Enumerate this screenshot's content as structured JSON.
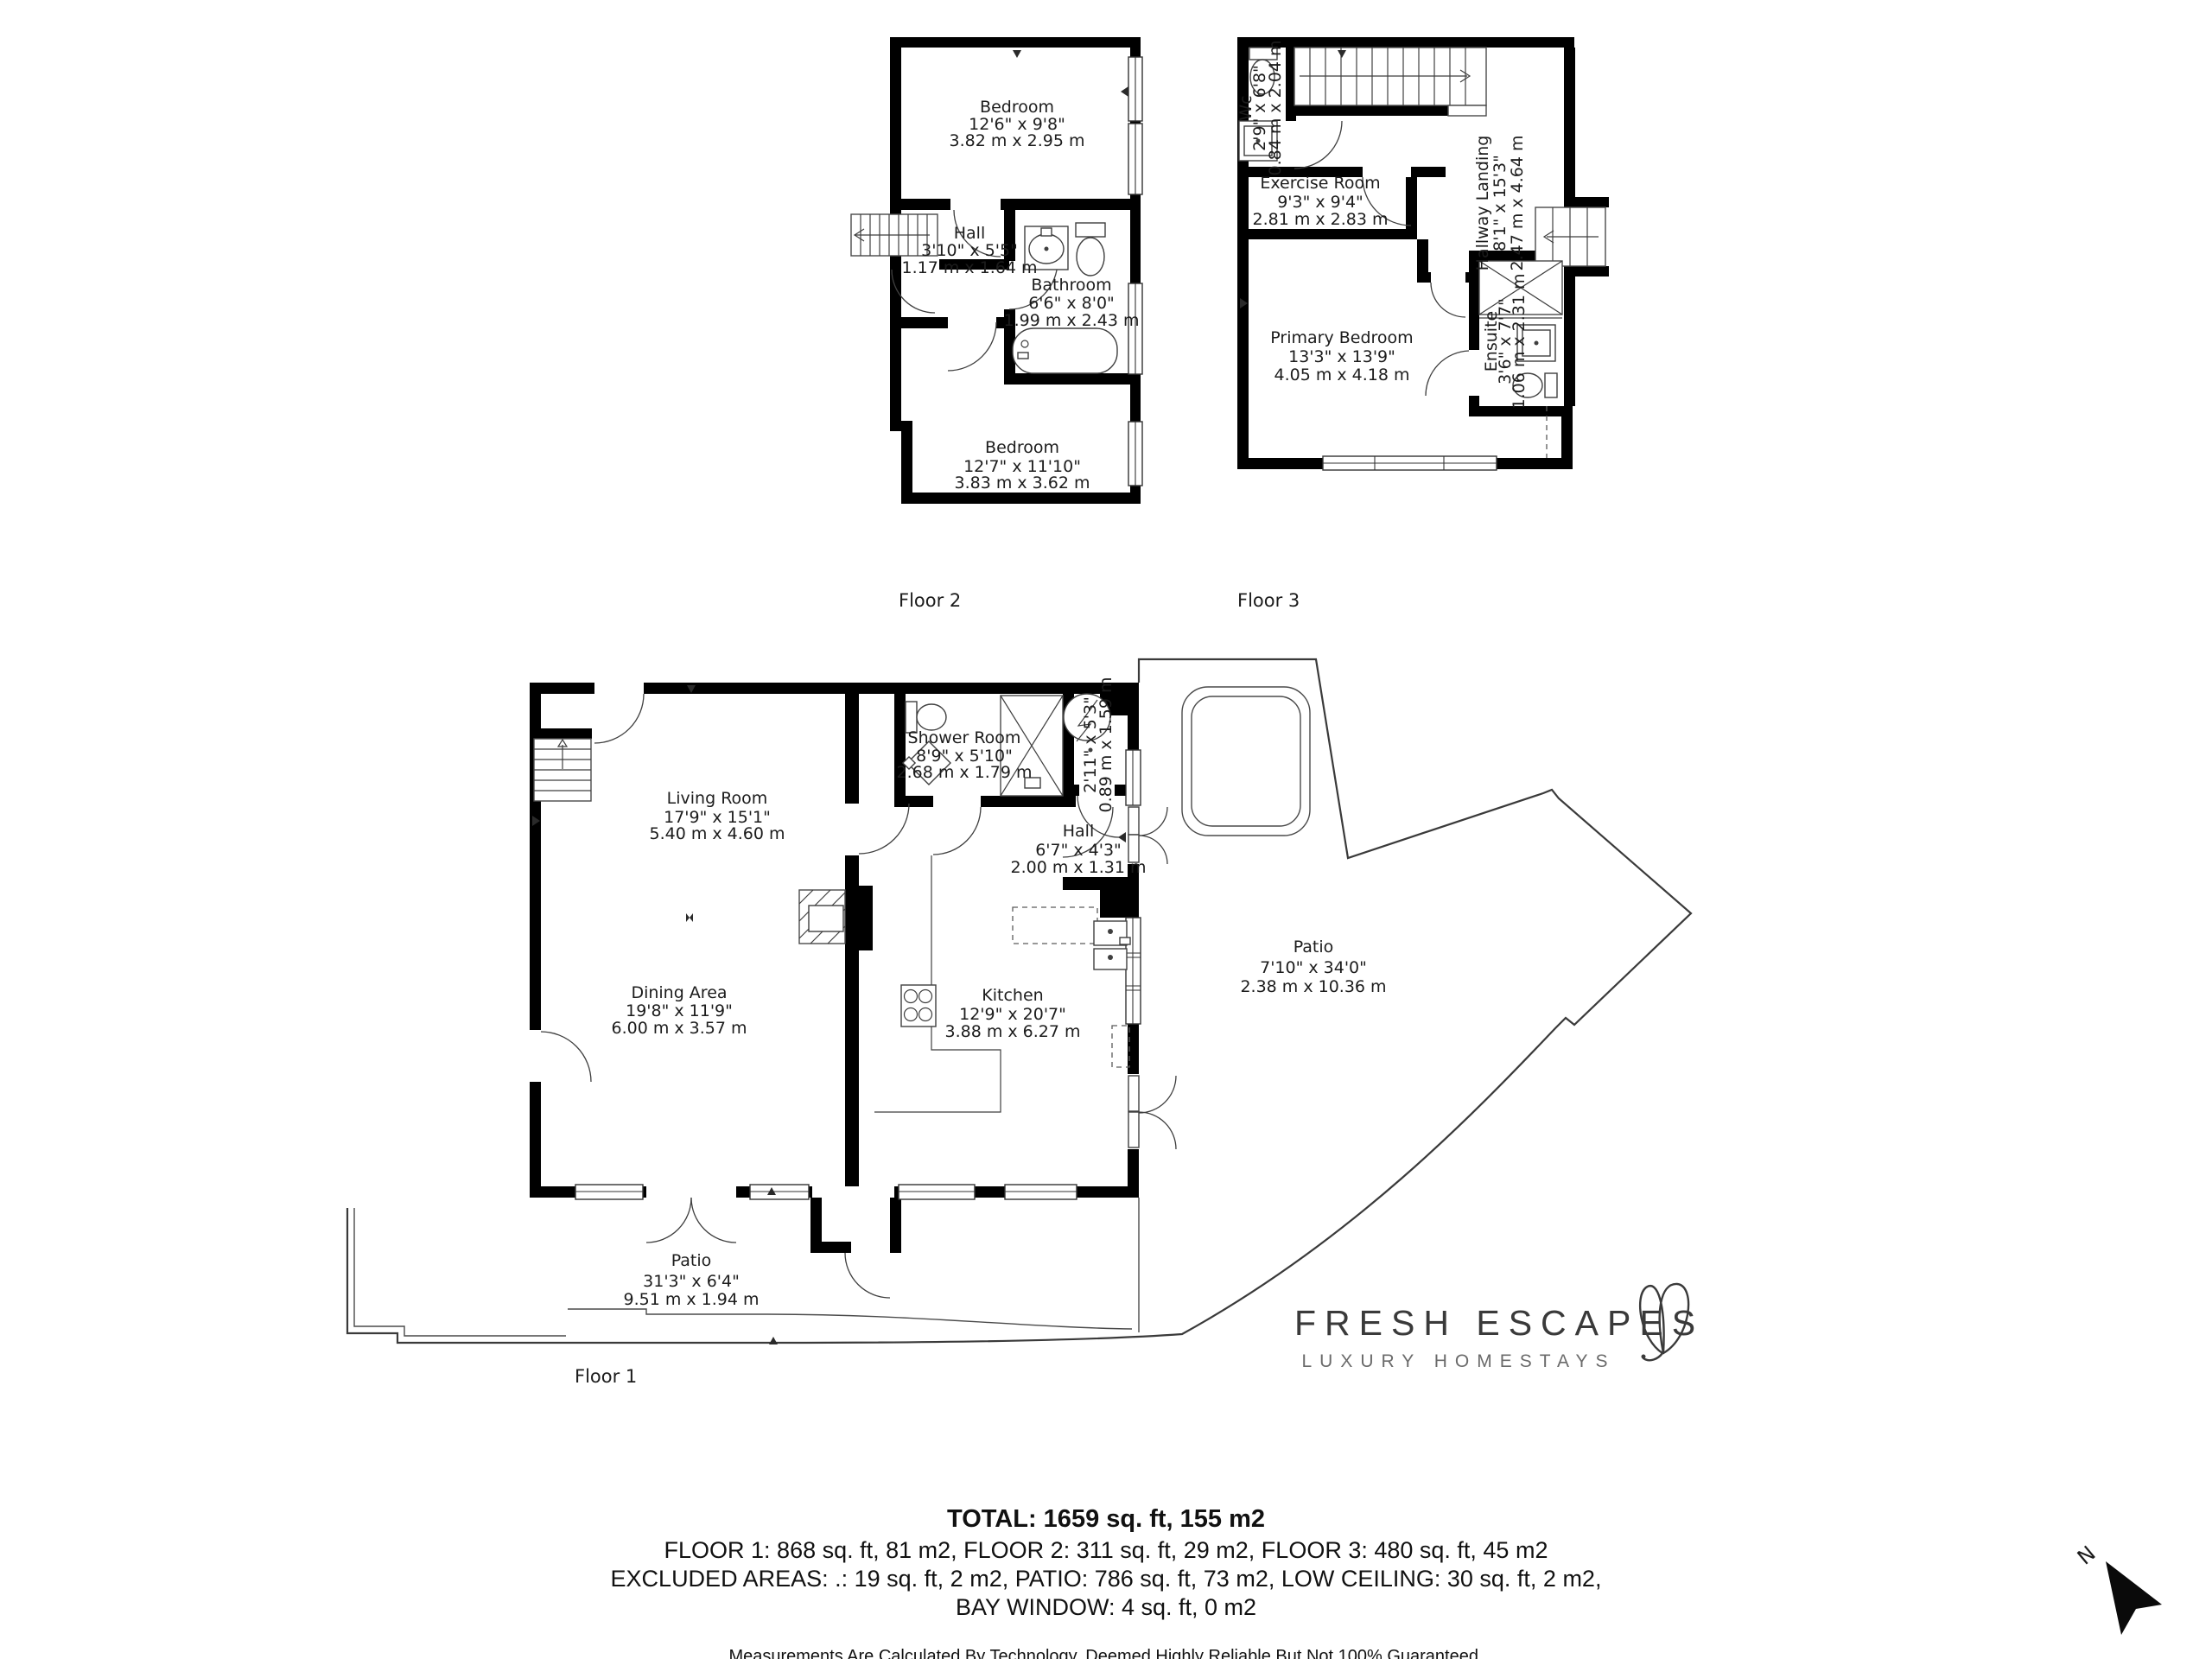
{
  "colors": {
    "wall": "#000000",
    "fixture_line": "#3f3f3f",
    "label_text": "#1c1c1c",
    "brand_text": "#3a3a3a",
    "tagline_text": "#6b6b6b"
  },
  "floor1": {
    "label": "Floor 1",
    "living_room": {
      "name": "Living Room",
      "imperial": "17'9\" x 15'1\"",
      "metric": "5.40 m x 4.60 m"
    },
    "dining_area": {
      "name": "Dining Area",
      "imperial": "19'8\" x 11'9\"",
      "metric": "6.00 m x 3.57 m"
    },
    "shower_room": {
      "name": "Shower Room",
      "imperial": "8'9\" x 5'10\"",
      "metric": "2.68 m x 1.79 m"
    },
    "closet": {
      "imperial": "2'11\" x 5'3\"",
      "metric": "0.89 m x 1.59 m"
    },
    "hall": {
      "name": "Hall",
      "imperial": "6'7\" x 4'3\"",
      "metric": "2.00 m x 1.31 m"
    },
    "kitchen": {
      "name": "Kitchen",
      "imperial": "12'9\" x 20'7\"",
      "metric": "3.88 m x 6.27 m"
    },
    "patio_side": {
      "name": "Patio",
      "imperial": "7'10\" x 34'0\"",
      "metric": "2.38 m x 10.36 m"
    },
    "patio_front": {
      "name": "Patio",
      "imperial": "31'3\" x 6'4\"",
      "metric": "9.51 m x 1.94 m"
    }
  },
  "floor2": {
    "label": "Floor 2",
    "bedroom_top": {
      "name": "Bedroom",
      "imperial": "12'6\" x 9'8\"",
      "metric": "3.82 m x 2.95 m"
    },
    "hall": {
      "name": "Hall",
      "imperial": "3'10\" x 5'5\"",
      "metric": "1.17 m x 1.64 m"
    },
    "bathroom": {
      "name": "Bathroom",
      "imperial": "6'6\" x 8'0\"",
      "metric": "1.99 m x 2.43 m"
    },
    "bedroom_bottom": {
      "name": "Bedroom",
      "imperial": "12'7\" x 11'10\"",
      "metric": "3.83 m x 3.62 m"
    }
  },
  "floor3": {
    "label": "Floor 3",
    "wc": {
      "name": "Wc",
      "imperial": "2'9\" x 6'8\"",
      "metric": "0.84 m x 2.04 m"
    },
    "exercise_room": {
      "name": "Exercise Room",
      "imperial": "9'3\" x 9'4\"",
      "metric": "2.81 m x 2.83 m"
    },
    "hallway_landing": {
      "name": "Hallway Landing",
      "imperial": "8'1\" x 15'3\"",
      "metric": "2.47 m x 4.64 m"
    },
    "primary_bedroom": {
      "name": "Primary Bedroom",
      "imperial": "13'3\" x 13'9\"",
      "metric": "4.05 m x 4.18 m"
    },
    "ensuite": {
      "name": "Ensuite",
      "imperial": "3'6\" x 7'7\"",
      "metric": "1.06 m x 2.31 m"
    }
  },
  "summary": {
    "total": "TOTAL: 1659 sq. ft, 155 m2",
    "floors": "FLOOR 1: 868 sq. ft, 81 m2, FLOOR 2: 311 sq. ft, 29 m2, FLOOR 3: 480 sq. ft, 45 m2",
    "excluded": "EXCLUDED AREAS: .: 19 sq. ft, 2 m2, PATIO: 786 sq. ft, 73 m2, LOW CEILING: 30 sq. ft, 2 m2,",
    "bay": "BAY WINDOW: 4 sq. ft, 0 m2",
    "disclaimer": "Measurements Are Calculated By Technology, Deemed Highly Reliable But Not 100% Guaranteed."
  },
  "brand": {
    "name": "FRESH ESCAPES",
    "tagline": "LUXURY HOMESTAYS"
  },
  "compass": {
    "label": "N"
  }
}
